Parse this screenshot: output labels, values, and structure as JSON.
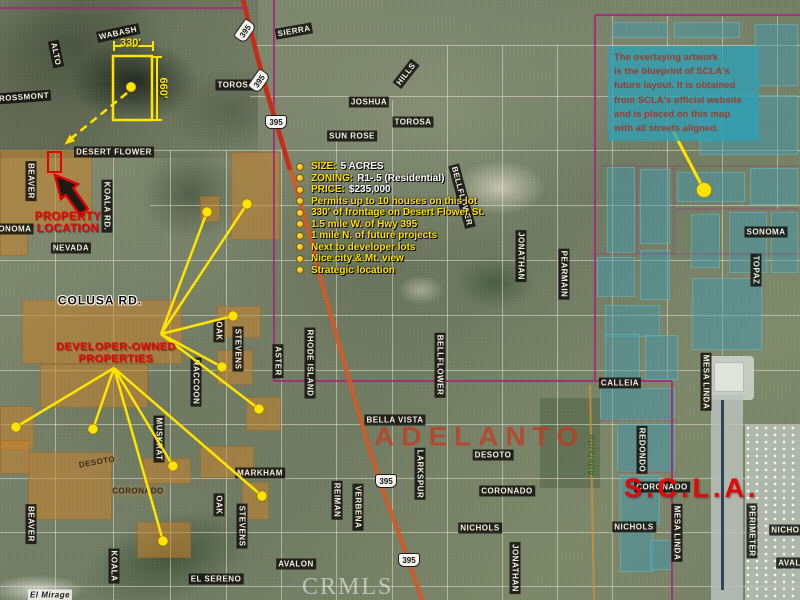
{
  "watermarks": {
    "crmls": "CRMLS",
    "adelanto": "ADELANTO",
    "scla": "S.C.L.A.",
    "adelanto_small": "Adelanto"
  },
  "callouts": {
    "property_location": {
      "line1": "PROPERTY",
      "line2": "LOCATION"
    },
    "developer": {
      "line1": "DEVELOPER-OWNED",
      "line2": "PROPERTIES"
    },
    "dimensions": {
      "width_label": "330'",
      "height_label": "660'"
    }
  },
  "overlay_note": {
    "lines": [
      "The overlaying artwork",
      "is the blueprint of SCLA's",
      "future layout.  It is obtained",
      "from SCLA's official website",
      "and is placed on this map",
      "with all streets aligned."
    ]
  },
  "listing": {
    "bullets": [
      {
        "label": "SIZE:",
        "value": "5  ACRES"
      },
      {
        "label": "ZONING:",
        "value": "R1-.5 (Residential)"
      },
      {
        "label": "PRICE:",
        "value": "$235,000"
      },
      {
        "text": "Permits up to 10 houses on this lot"
      },
      {
        "text": "330' of frontage on Desert Flower St."
      },
      {
        "text": "1.5 mile W. of Hwy 395"
      },
      {
        "text": "1 mile N. of future projects"
      },
      {
        "text": "Next to developer lots"
      },
      {
        "text": "Nice city & Mt. view"
      },
      {
        "text": "Strategic location"
      }
    ]
  },
  "highway_shields": [
    {
      "t": "395",
      "x": 245,
      "y": 31,
      "r": -55
    },
    {
      "t": "395",
      "x": 259,
      "y": 81,
      "r": -55
    },
    {
      "t": "395",
      "x": 276,
      "y": 122,
      "r": 0
    },
    {
      "t": "395",
      "x": 386,
      "y": 481,
      "r": 0
    },
    {
      "t": "395",
      "x": 409,
      "y": 560,
      "r": 0
    }
  ],
  "streets": [
    {
      "t": "WABASH",
      "x": 118,
      "y": 33,
      "r": -12,
      "s": "d"
    },
    {
      "t": "ALTO",
      "x": 56,
      "y": 54,
      "r": 78,
      "s": "d"
    },
    {
      "t": "ROSSMONT",
      "x": 24,
      "y": 97,
      "r": -4,
      "s": "d"
    },
    {
      "t": "TOROSA",
      "x": 236,
      "y": 85,
      "r": 0,
      "s": "d"
    },
    {
      "t": "SIERRA",
      "x": 294,
      "y": 31,
      "r": -10,
      "s": "d"
    },
    {
      "t": "HILLS",
      "x": 406,
      "y": 74,
      "r": -52,
      "s": "d"
    },
    {
      "t": "JOSHUA",
      "x": 369,
      "y": 102,
      "r": 0,
      "s": "d"
    },
    {
      "t": "TOROSA",
      "x": 413,
      "y": 122,
      "r": 0,
      "s": "d"
    },
    {
      "t": "SUN ROSE",
      "x": 352,
      "y": 136,
      "r": 0,
      "s": "d"
    },
    {
      "t": "DESERT FLOWER",
      "x": 114,
      "y": 152,
      "r": 0,
      "s": "d"
    },
    {
      "t": "BEAVER",
      "x": 31,
      "y": 181,
      "r": 90,
      "s": "d"
    },
    {
      "t": "SONOMA",
      "x": 12,
      "y": 229,
      "r": 0,
      "s": "d"
    },
    {
      "t": "KOALA RD.",
      "x": 107,
      "y": 206,
      "r": 90,
      "s": "d"
    },
    {
      "t": "NEVADA",
      "x": 71,
      "y": 248,
      "r": 0,
      "s": "d"
    },
    {
      "t": "BELLFLOWER",
      "x": 462,
      "y": 196,
      "r": 75,
      "s": "d"
    },
    {
      "t": "COLUSA RD.",
      "x": 100,
      "y": 301,
      "r": 0,
      "s": "h"
    },
    {
      "t": "OAK",
      "x": 219,
      "y": 331,
      "r": 90,
      "s": "d"
    },
    {
      "t": "STEVENS",
      "x": 238,
      "y": 349,
      "r": 90,
      "s": "d"
    },
    {
      "t": "ASTER",
      "x": 278,
      "y": 361,
      "r": 90,
      "s": "d"
    },
    {
      "t": "RHODE ISLAND",
      "x": 310,
      "y": 363,
      "r": 90,
      "s": "d"
    },
    {
      "t": "BELLFLOWER",
      "x": 440,
      "y": 365,
      "r": 90,
      "s": "d"
    },
    {
      "t": "RACCOON",
      "x": 196,
      "y": 382,
      "r": 90,
      "s": "d"
    },
    {
      "t": "MUSKRAT",
      "x": 159,
      "y": 439,
      "r": 90,
      "s": "d"
    },
    {
      "t": "JONATHAN",
      "x": 521,
      "y": 256,
      "r": 90,
      "s": "d"
    },
    {
      "t": "PEARMAIN",
      "x": 564,
      "y": 274,
      "r": 90,
      "s": "d"
    },
    {
      "t": "SONOMA",
      "x": 766,
      "y": 232,
      "r": 0,
      "s": "d"
    },
    {
      "t": "TOPAZ",
      "x": 756,
      "y": 270,
      "r": 90,
      "s": "d"
    },
    {
      "t": "CALLEIA",
      "x": 620,
      "y": 383,
      "r": 0,
      "s": "d"
    },
    {
      "t": "MESA LINDA",
      "x": 706,
      "y": 382,
      "r": 90,
      "s": "d"
    },
    {
      "t": "BELLA VISTA",
      "x": 395,
      "y": 420,
      "r": 0,
      "s": "d"
    },
    {
      "t": "DESOTO",
      "x": 493,
      "y": 455,
      "r": 0,
      "s": "d"
    },
    {
      "t": "LARKSPUR",
      "x": 420,
      "y": 474,
      "r": 90,
      "s": "d"
    },
    {
      "t": "CORONADO",
      "x": 507,
      "y": 491,
      "r": 0,
      "s": "d"
    },
    {
      "t": "NICHOLS",
      "x": 480,
      "y": 528,
      "r": 0,
      "s": "d"
    },
    {
      "t": "REIMAN",
      "x": 337,
      "y": 500,
      "r": 90,
      "s": "d"
    },
    {
      "t": "VERBENA",
      "x": 358,
      "y": 507,
      "r": 90,
      "s": "d"
    },
    {
      "t": "AVALON",
      "x": 296,
      "y": 564,
      "r": 0,
      "s": "d"
    },
    {
      "t": "JONATHAN",
      "x": 515,
      "y": 568,
      "r": 90,
      "s": "d"
    },
    {
      "t": "EL SERENO",
      "x": 216,
      "y": 579,
      "r": 0,
      "s": "d"
    },
    {
      "t": "MARKHAM",
      "x": 260,
      "y": 473,
      "r": 0,
      "s": "d"
    },
    {
      "t": "OAK",
      "x": 219,
      "y": 505,
      "r": 90,
      "s": "d"
    },
    {
      "t": "STEVENS",
      "x": 242,
      "y": 526,
      "r": 90,
      "s": "d"
    },
    {
      "t": "KOALA",
      "x": 114,
      "y": 566,
      "r": 90,
      "s": "d"
    },
    {
      "t": "BEAVER",
      "x": 31,
      "y": 524,
      "r": 90,
      "s": "d"
    },
    {
      "t": "REDONDO",
      "x": 642,
      "y": 450,
      "r": 90,
      "s": "d"
    },
    {
      "t": "MESA LINDA",
      "x": 677,
      "y": 533,
      "r": 90,
      "s": "d"
    },
    {
      "t": "NICHOLS",
      "x": 634,
      "y": 527,
      "r": 0,
      "s": "d"
    },
    {
      "t": "PERIMETER",
      "x": 752,
      "y": 531,
      "r": 90,
      "s": "d"
    },
    {
      "t": "NICHOLS",
      "x": 791,
      "y": 530,
      "r": 0,
      "s": "d"
    },
    {
      "t": "AVALON",
      "x": 796,
      "y": 563,
      "r": 0,
      "s": "d"
    },
    {
      "t": "CORONADO",
      "x": 662,
      "y": 487,
      "r": 0,
      "s": "d"
    },
    {
      "t": "El Mirage",
      "x": 50,
      "y": 595,
      "r": 0,
      "s": "w"
    },
    {
      "t": "DESOTO",
      "x": 97,
      "y": 462,
      "r": -10,
      "s": "f"
    },
    {
      "t": "CORONADO",
      "x": 138,
      "y": 491,
      "r": 0,
      "s": "f"
    },
    {
      "t": "Adelanto",
      "x": 592,
      "y": 455,
      "r": -90,
      "s": "g"
    }
  ],
  "parcels": {
    "orange": [
      [
        0,
        150,
        92,
        76
      ],
      [
        0,
        226,
        28,
        30
      ],
      [
        200,
        196,
        20,
        26
      ],
      [
        231,
        152,
        49,
        88
      ],
      [
        22,
        300,
        160,
        64
      ],
      [
        40,
        364,
        108,
        44
      ],
      [
        0,
        406,
        34,
        44
      ],
      [
        217,
        306,
        44,
        32
      ],
      [
        217,
        350,
        36,
        35
      ],
      [
        246,
        397,
        35,
        34
      ],
      [
        28,
        452,
        84,
        68
      ],
      [
        0,
        440,
        30,
        34
      ],
      [
        143,
        458,
        48,
        26
      ],
      [
        200,
        446,
        54,
        32
      ],
      [
        242,
        482,
        27,
        38
      ],
      [
        137,
        522,
        54,
        36
      ]
    ],
    "teal": [
      [
        612,
        22,
        56,
        16
      ],
      [
        674,
        22,
        66,
        16
      ],
      [
        755,
        24,
        43,
        62
      ],
      [
        700,
        95,
        98,
        60
      ],
      [
        607,
        167,
        28,
        86
      ],
      [
        640,
        169,
        30,
        75
      ],
      [
        677,
        172,
        68,
        30
      ],
      [
        750,
        168,
        48,
        37
      ],
      [
        691,
        214,
        29,
        54
      ],
      [
        729,
        212,
        38,
        61
      ],
      [
        771,
        212,
        27,
        61
      ],
      [
        597,
        257,
        38,
        40
      ],
      [
        640,
        250,
        30,
        50
      ],
      [
        692,
        278,
        70,
        72
      ],
      [
        605,
        305,
        55,
        32
      ],
      [
        605,
        334,
        35,
        46
      ],
      [
        645,
        335,
        33,
        45
      ],
      [
        600,
        388,
        75,
        32
      ],
      [
        617,
        424,
        58,
        48
      ],
      [
        620,
        475,
        40,
        50
      ],
      [
        620,
        532,
        33,
        40
      ],
      [
        650,
        540,
        23,
        30
      ]
    ]
  },
  "roads": {
    "v": [
      [
        55,
        150,
        600
      ],
      [
        113,
        150,
        600
      ],
      [
        170,
        150,
        600
      ],
      [
        226,
        150,
        600
      ],
      [
        281,
        140,
        600
      ],
      [
        336,
        140,
        600
      ],
      [
        392,
        100,
        600
      ],
      [
        447,
        45,
        600
      ],
      [
        502,
        45,
        600
      ],
      [
        557,
        45,
        600
      ],
      [
        612,
        15,
        600
      ],
      [
        667,
        15,
        380
      ],
      [
        722,
        15,
        355
      ],
      [
        777,
        15,
        210
      ]
    ],
    "h": [
      [
        45,
        255,
        800
      ],
      [
        96,
        250,
        800
      ],
      [
        150,
        0,
        800
      ],
      [
        205,
        150,
        800
      ],
      [
        260,
        0,
        800
      ],
      [
        315,
        0,
        800
      ],
      [
        370,
        0,
        800
      ],
      [
        424,
        0,
        800
      ],
      [
        478,
        0,
        800
      ],
      [
        532,
        0,
        800
      ],
      [
        586,
        0,
        800
      ]
    ]
  },
  "annotations": {
    "lines": [
      [
        161,
        334,
        207,
        212
      ],
      [
        161,
        334,
        247,
        204
      ],
      [
        161,
        334,
        233,
        316
      ],
      [
        161,
        334,
        222,
        367
      ],
      [
        161,
        334,
        259,
        409
      ],
      [
        114,
        368,
        16,
        427
      ],
      [
        114,
        368,
        93,
        429
      ],
      [
        114,
        368,
        173,
        466
      ],
      [
        114,
        368,
        163,
        541
      ],
      [
        114,
        368,
        262,
        496
      ],
      [
        673,
        131,
        702,
        186
      ]
    ],
    "dashed_line": [
      127,
      93,
      68,
      141
    ],
    "dots": [
      [
        131,
        87
      ],
      [
        207,
        212
      ],
      [
        247,
        204
      ],
      [
        233,
        316
      ],
      [
        222,
        367
      ],
      [
        259,
        409
      ],
      [
        16,
        427
      ],
      [
        93,
        429
      ],
      [
        173,
        466
      ],
      [
        163,
        541
      ],
      [
        262,
        496
      ],
      [
        704,
        190
      ]
    ]
  },
  "colors": {
    "annotation_yellow": "#ffe400",
    "callout_red": "#ee0000",
    "boundary_magenta": "#a82480",
    "highway_orange": "#cf5a2a",
    "parcel_orange": "#c6842e",
    "blueprint_teal": "#4498ac",
    "note_teal": "#30a0b4"
  }
}
